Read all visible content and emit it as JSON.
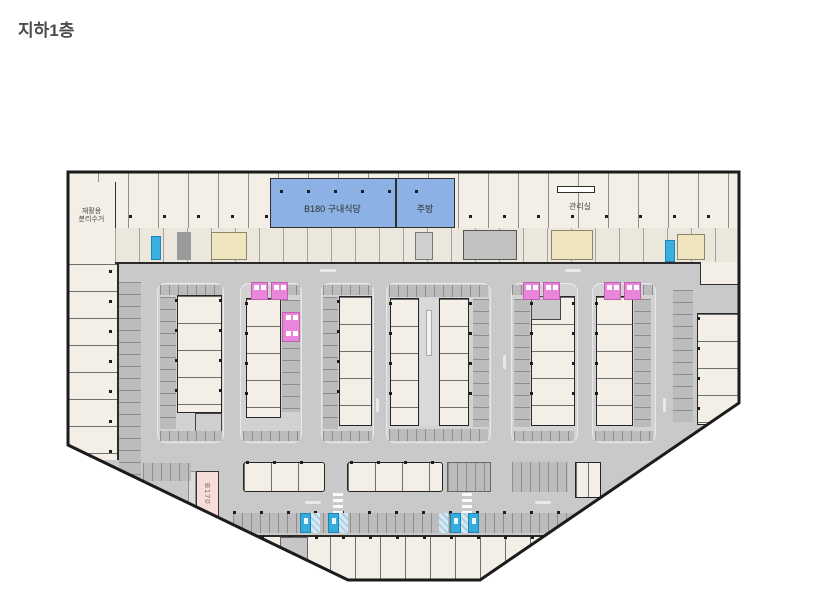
{
  "page": {
    "title": "지하1층"
  },
  "plan": {
    "labels": {
      "cafeteria": "B180 구내식당",
      "kitchen": "주방",
      "management": "관리실",
      "recycling_line1": "재활용",
      "recycling_line2": "분리수거",
      "unit_b170": "B170"
    },
    "colors": {
      "cafeteria_blue": "#8cb1e5",
      "reserved_stall_pink": "#e986da",
      "accessible_stall_blue": "#36abdd",
      "unit_b170_rose": "#f7ddd8",
      "parking_floor_gray": "#c9c9c9",
      "room_beige": "#f3efe7",
      "wall_black": "#1b1b1b"
    }
  }
}
